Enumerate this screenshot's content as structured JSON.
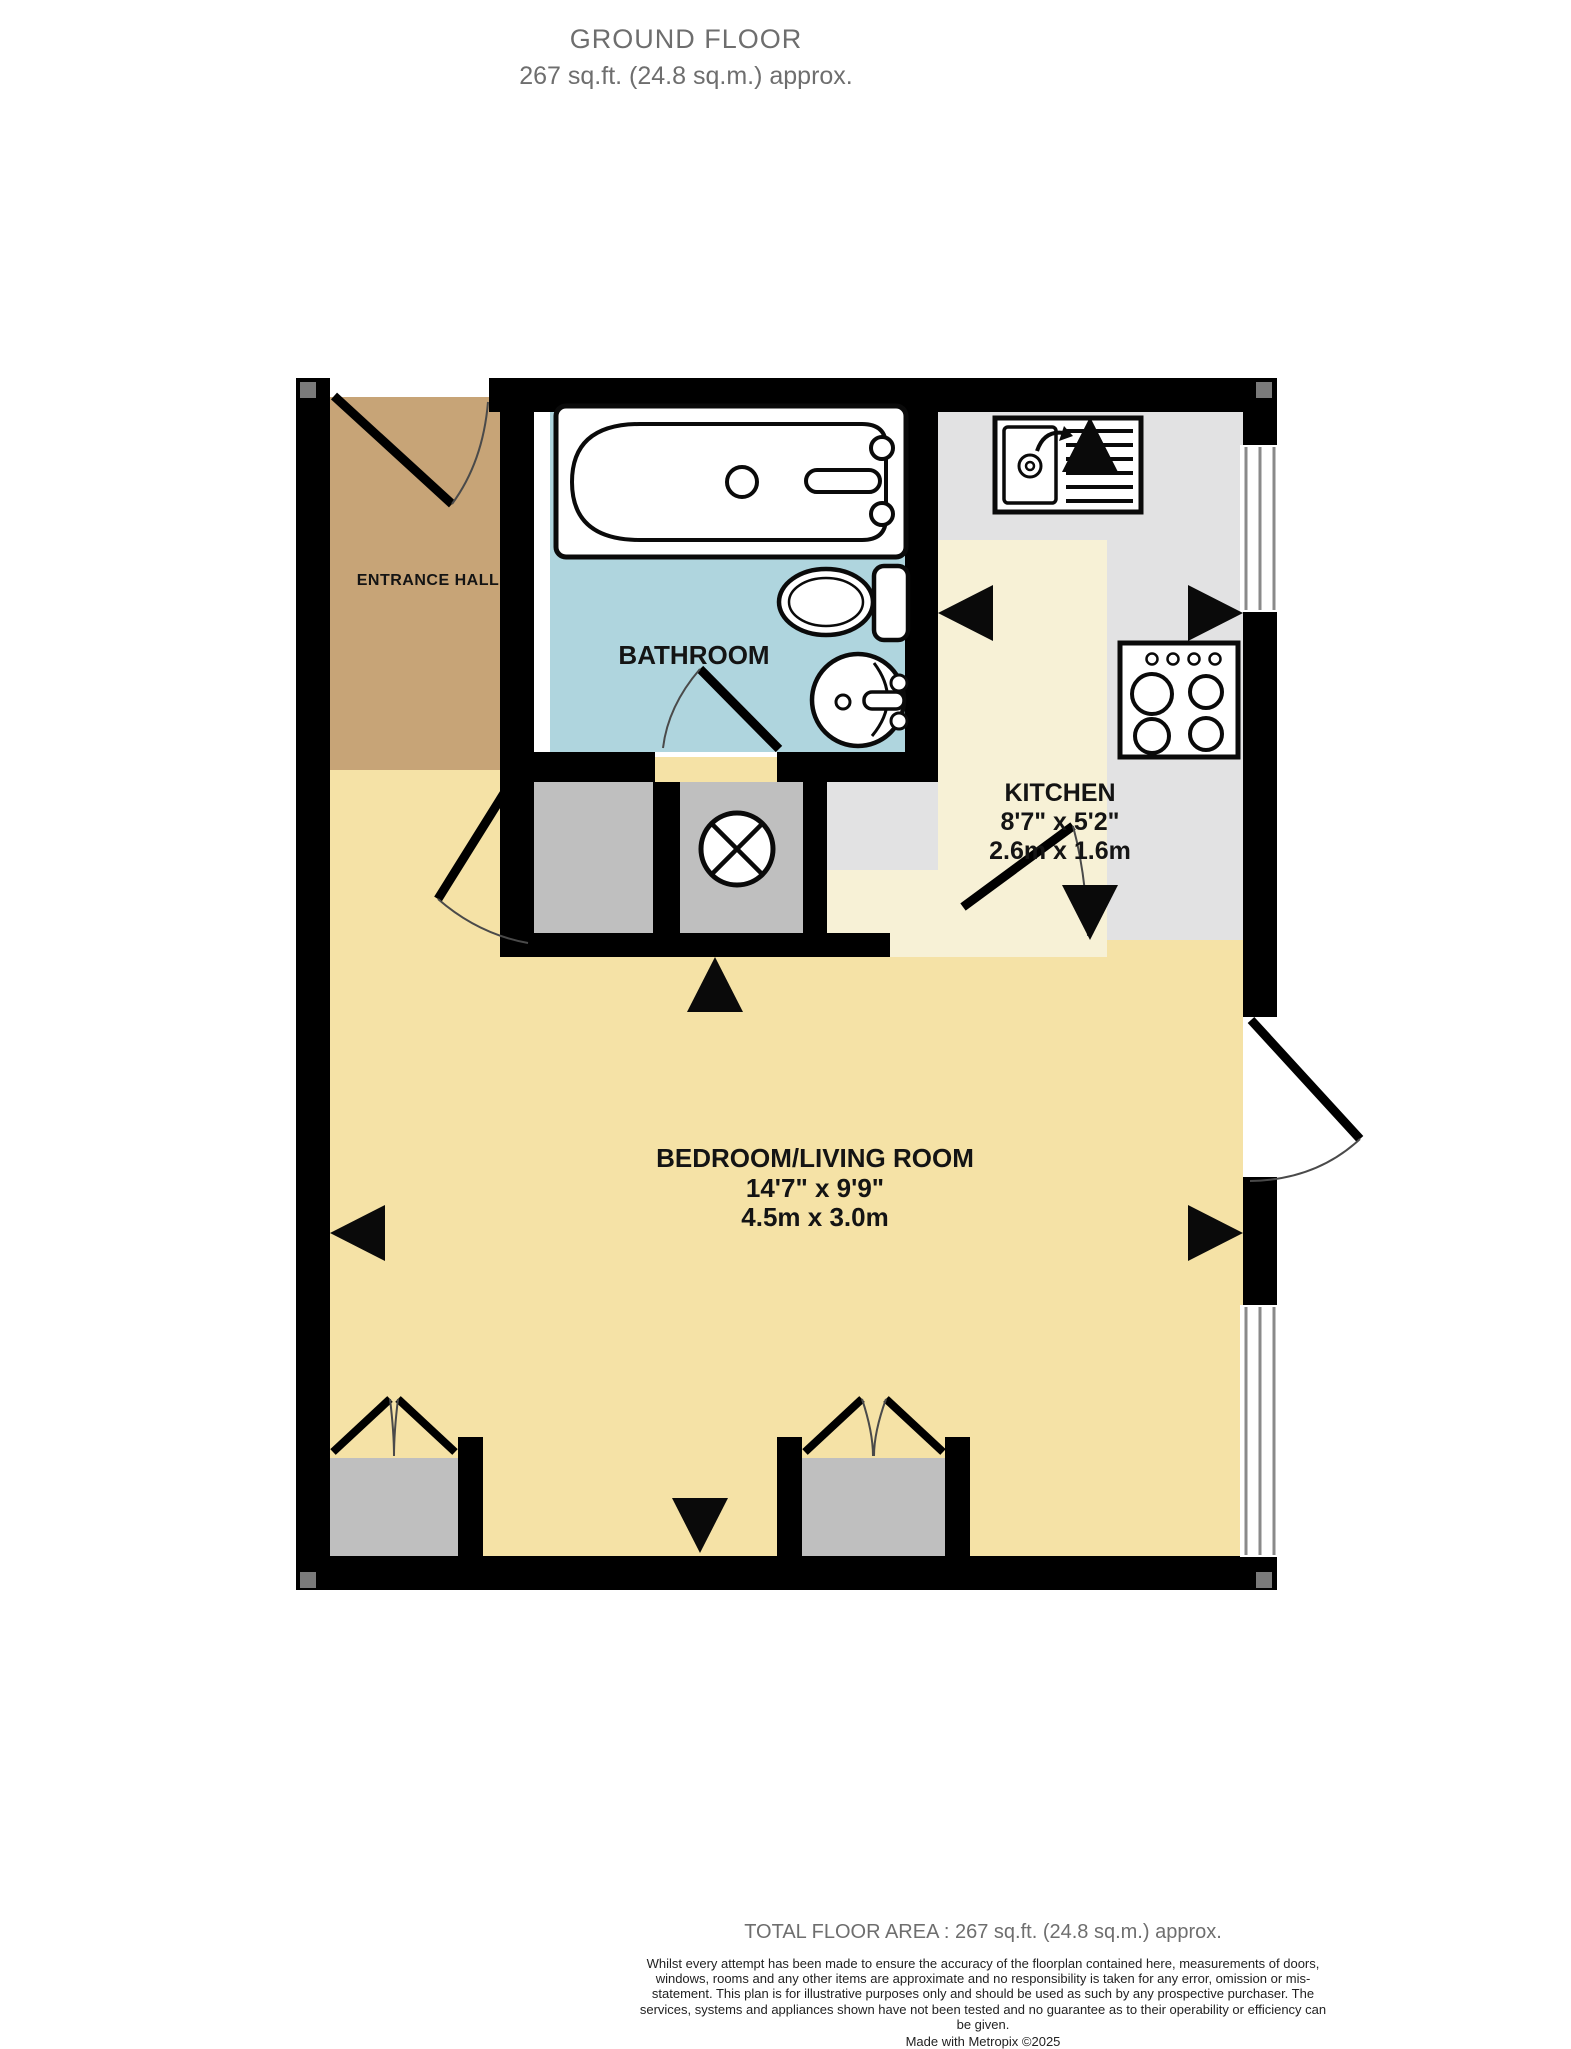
{
  "header": {
    "title": "GROUND FLOOR",
    "subtitle": "267 sq.ft. (24.8 sq.m.) approx."
  },
  "rooms": {
    "entrance_hall": {
      "name": "ENTRANCE HALL"
    },
    "bathroom": {
      "name": "BATHROOM"
    },
    "kitchen": {
      "name": "KITCHEN",
      "dims_imperial": "8'7\" x 5'2\"",
      "dims_metric": "2.6m x 1.6m"
    },
    "bedroom_living": {
      "name": "BEDROOM/LIVING ROOM",
      "dims_imperial": "14'7\" x 9'9\"",
      "dims_metric": "4.5m x 3.0m"
    }
  },
  "footer": {
    "total_area": "TOTAL FLOOR AREA : 267 sq.ft. (24.8 sq.m.) approx.",
    "disclaimer": "Whilst every attempt has been made to ensure the accuracy of the floorplan contained here, measurements of doors, windows, rooms and any other items are approximate and no responsibility is taken for any error, omission or mis-statement. This plan is for illustrative purposes only and should be used as such by any prospective purchaser. The services, systems and appliances shown have not been tested and no guarantee as to their operability or efficiency can be given.",
    "credit": "Made with Metropix ©2025"
  },
  "colors": {
    "hall_floor": "#C7A477",
    "bathroom_floor": "#AFD5DE",
    "bedroom_floor": "#F5E2A6",
    "kitchen_floor": "#F7F1D6",
    "worktop": "#E2E2E3",
    "cupboard": "#BFBFBF",
    "wall": "#000000",
    "window_line": "#8A8A8A",
    "heading_text": "#6E6E6E",
    "label_text": "#141414"
  },
  "symbols": {
    "measure_arrow": "black-triangle",
    "fan": "circled-x",
    "door": "quarter-arc-swing",
    "window": "triple-line"
  }
}
